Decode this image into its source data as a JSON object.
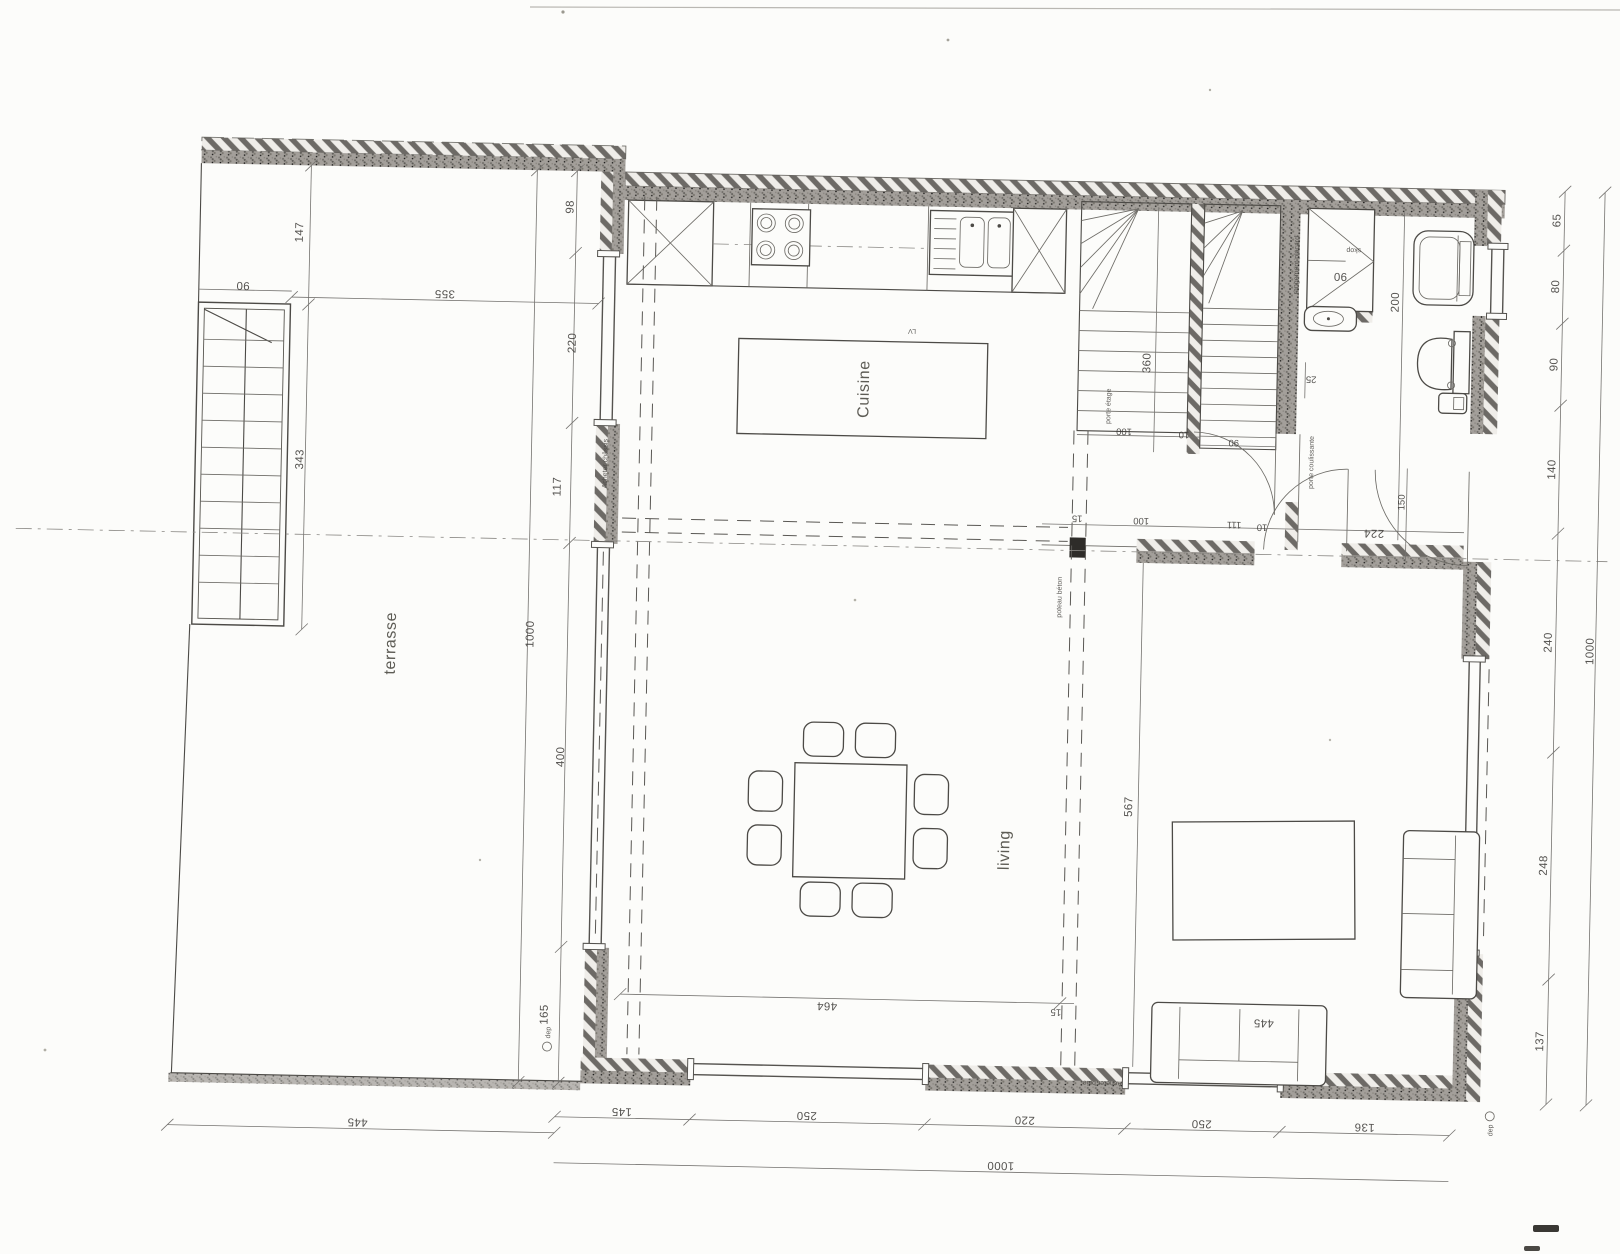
{
  "rooms": {
    "kitchen": "Cuisine",
    "living": "living",
    "terrace": "terrasse"
  },
  "annotations": {
    "poteau": "poteau béton",
    "porte_coulissante": "porte coulissante",
    "porte_etage": "porte étage",
    "rangement": "rangement placard",
    "acheter_chassis": "Acheter châssis",
    "acheter_baie": "Acheter baie",
    "lave_vaisselle": "LV",
    "skop": "skop",
    "dep": "dep"
  },
  "dims": {
    "west_inner": [
      "98",
      "220",
      "117",
      "400",
      "165"
    ],
    "west_total": "1000",
    "terrace": {
      "w147": "147",
      "w90": "90",
      "w343": "343",
      "w355": "355",
      "w445": "445"
    },
    "south": [
      "145",
      "250",
      "220",
      "250",
      "136"
    ],
    "south_total": "1000",
    "east": [
      "65",
      "80",
      "90",
      "140",
      "240",
      "248",
      "137"
    ],
    "east_total": "1000",
    "interior": {
      "stair360": "360",
      "u100": "100",
      "u10": "10",
      "door90": "90",
      "h15": "15",
      "h100": "100",
      "h111": "111",
      "h10": "10",
      "h224": "224",
      "door150": "150",
      "closet90": "90",
      "bath200": "200",
      "bath25": "25",
      "living567": "567",
      "living464": "464",
      "axis15": "15",
      "sofa445": "445"
    }
  }
}
